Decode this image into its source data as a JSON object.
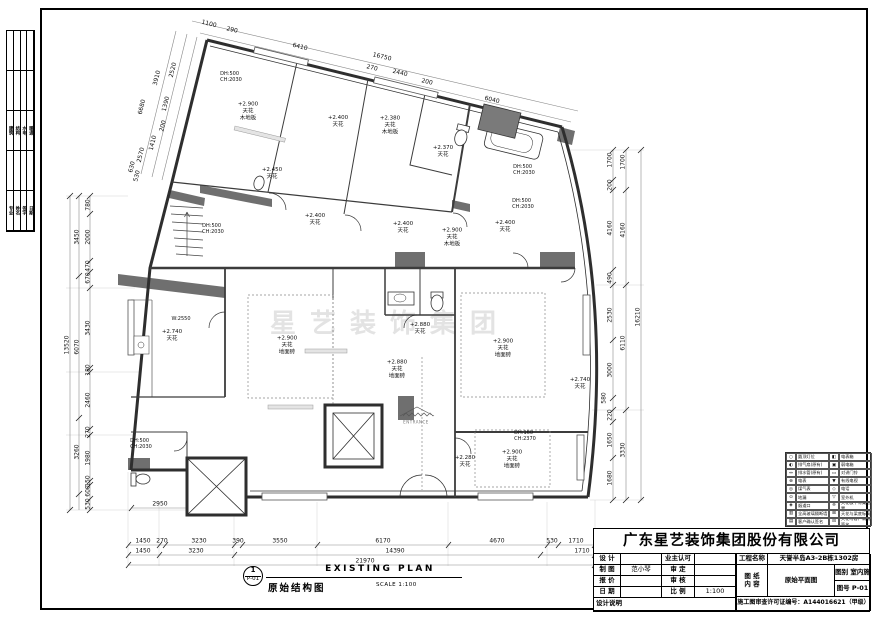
{
  "title_block": {
    "company": "广东星艺装饰集团股份有限公司",
    "labels": {
      "design": "设 计",
      "owner_ok": "业主认可",
      "draft": "制 图",
      "approve": "审 定",
      "quote": "报 价",
      "review": "审 核",
      "date": "日 期",
      "scale": "比 例",
      "project_name": "工程名称",
      "paper1": "图 纸",
      "paper2": "内 容",
      "category": "图别",
      "sheet_no": "图号",
      "design_notes": "设计说明",
      "permit": "施工图审查许可证编号："
    },
    "values": {
      "draft_by": "范小琴",
      "scale": "1:100",
      "project": "天誉半岛A3-2B栋1302房",
      "drawing_content": "原始平面图",
      "category": "室内施",
      "sheet_no": "P-01",
      "permit_no": "A144016621（甲级）"
    }
  },
  "plan_title": {
    "num": "1",
    "code": "P-01",
    "title_en": "EXISTING PLAN",
    "title_cn": "原始结构图",
    "scale": "SCALE 1:100"
  },
  "watermark": "星艺装饰集团",
  "dims": {
    "b1": [
      "1450",
      "270",
      "3230",
      "390",
      "3550",
      "6170",
      "4670",
      "530",
      "1710"
    ],
    "b2": [
      "1450",
      "3230",
      "14390",
      "1710"
    ],
    "b3": [
      "21970"
    ],
    "bx": [
      "2950"
    ],
    "lo": [
      "13520"
    ],
    "lm": [
      "3450",
      "6070",
      "3260"
    ],
    "li": [
      "780",
      "2000",
      "470",
      "670",
      "3430",
      "180",
      "2460",
      "270",
      "1980",
      "150",
      "600",
      "530"
    ],
    "ri": [
      "1700",
      "200",
      "4160",
      "490",
      "2530",
      "3000",
      "580",
      "220",
      "1650",
      "1680"
    ],
    "rm": [
      "1700",
      "4160",
      "6110",
      "3330"
    ],
    "ro": [
      "16210"
    ],
    "t": [
      "1100",
      "290",
      "6410",
      "16750",
      "270",
      "2440",
      "200",
      "6040"
    ],
    "tl": [
      "2520",
      "3910",
      "6680",
      "1390",
      "200",
      "1410",
      "2570",
      "630",
      "530"
    ]
  },
  "rooms": {
    "r1": [
      "+2.900",
      "天花",
      "木地板"
    ],
    "r2": [
      "+2.400",
      "天花"
    ],
    "r3": [
      "+2.380",
      "天花",
      "木地板"
    ],
    "r4": [
      "+2.450",
      "天花"
    ],
    "r5": [
      "+2.370",
      "天花"
    ],
    "r6": [
      "+2.400",
      "天花"
    ],
    "r7": [
      "+2.400",
      "天花"
    ],
    "r8": [
      "+2.900",
      "天花",
      "木地板"
    ],
    "r9": [
      "+2.400",
      "天花"
    ],
    "r10": [
      "+2.740",
      "天花"
    ],
    "r11": [
      "+2.900",
      "天花",
      "地面砖"
    ],
    "r12": [
      "+2.880",
      "天花"
    ],
    "r13": [
      "+2.880",
      "天花",
      "地面砖"
    ],
    "r14": [
      "+2.900",
      "天花",
      "地面砖"
    ],
    "r15": [
      "+2.740",
      "天花"
    ],
    "r16": [
      "+2.900",
      "天花",
      "地面砖"
    ],
    "r17": [
      "+2.280",
      "天花"
    ]
  },
  "ann": {
    "a1": [
      "DH:500",
      "CH:2030"
    ],
    "a2": [
      "DH:500",
      "CH:2030"
    ],
    "a3": [
      "DH:500",
      "CH:2030"
    ],
    "a4": [
      "DH:500",
      "CH:2030"
    ],
    "a5": [
      "DH:500",
      "CH:2030"
    ],
    "a6": [
      "DH:160",
      "CH:2370"
    ],
    "a7": [
      "W:2550"
    ],
    "a8": [
      "ENTRANCE"
    ]
  },
  "legend": {
    "rows": [
      {
        "s1": "○",
        "l1": "圆顶灯位",
        "s2": "◧",
        "l2": "电表箱"
      },
      {
        "s1": "◐",
        "l1": "排气扇(原有)",
        "s2": "▣",
        "l2": "弱电箱"
      },
      {
        "s1": "↔",
        "l1": "排水管(原有)",
        "s2": "▭",
        "l2": "对讲门铃"
      },
      {
        "s1": "⊕",
        "l1": "电表",
        "s2": "▼",
        "l2": "有线电视"
      },
      {
        "s1": "◎",
        "l1": "煤气表",
        "s2": "◇",
        "l2": "电话"
      },
      {
        "s1": "⊙",
        "l1": "地漏",
        "s2": "▽",
        "l2": "室外机"
      },
      {
        "s1": "◈",
        "l1": "烟道口",
        "s2": "※",
        "l2": "天花板下有梁位置"
      },
      {
        "s1": "▥",
        "l1": "全高玻璃隔断墙",
        "s2": "⊞",
        "l2": "天花与梁底标高"
      },
      {
        "s1": "▤",
        "l1": "客户确认签名",
        "s2": "⊟",
        "l2": "天花与客户确认签名"
      }
    ]
  },
  "left_strip": {
    "g1": [
      "建筑",
      "结构",
      "水电",
      "暖通"
    ],
    "g2": [
      "专业",
      "姓名",
      "签字",
      "日期"
    ]
  }
}
